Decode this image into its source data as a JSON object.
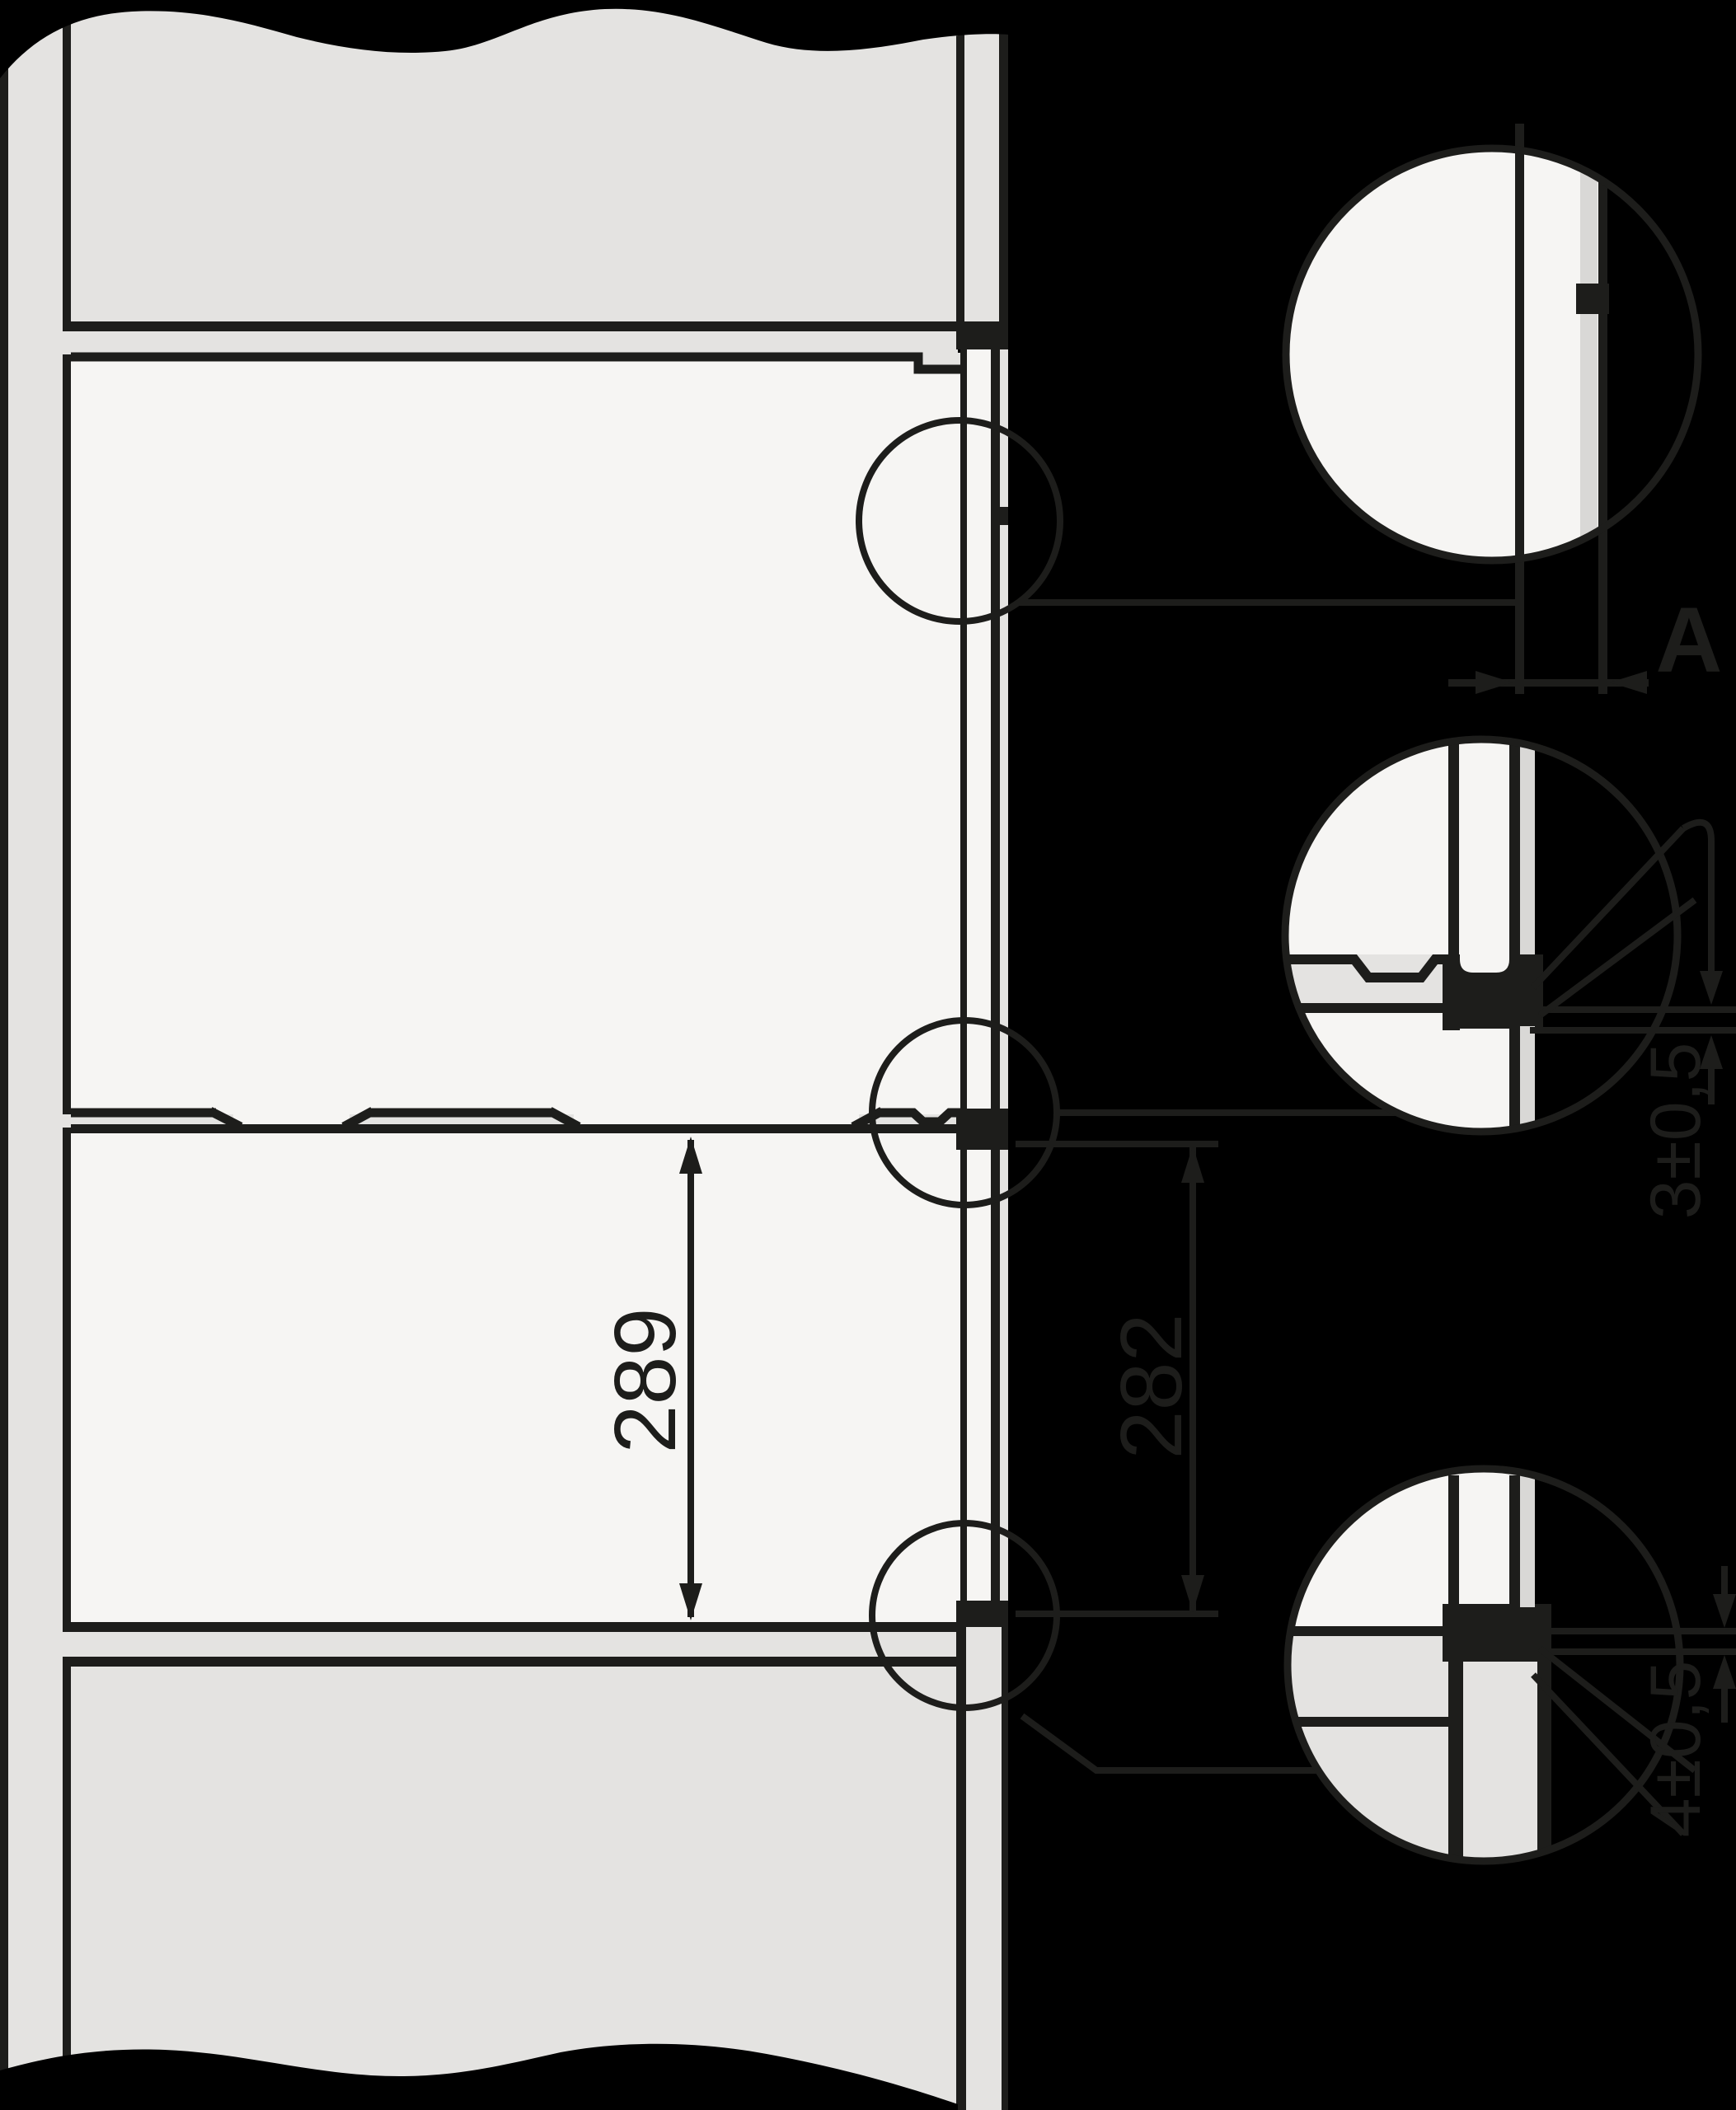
{
  "diagram": {
    "kind": "built-in appliance installation cross-section with detail callouts",
    "labels": {
      "niche_height": "289",
      "front_spacing": "282",
      "gap": "A",
      "shelf_joint_tolerance": "3±0,5",
      "bottom_joint_tolerance": "4±0,5"
    },
    "colors": {
      "bg": "#000000",
      "line": "#1d1d1b",
      "gray": "#e4e3e1",
      "white": "#f6f5f3",
      "gray2": "#d9d8d6"
    }
  }
}
